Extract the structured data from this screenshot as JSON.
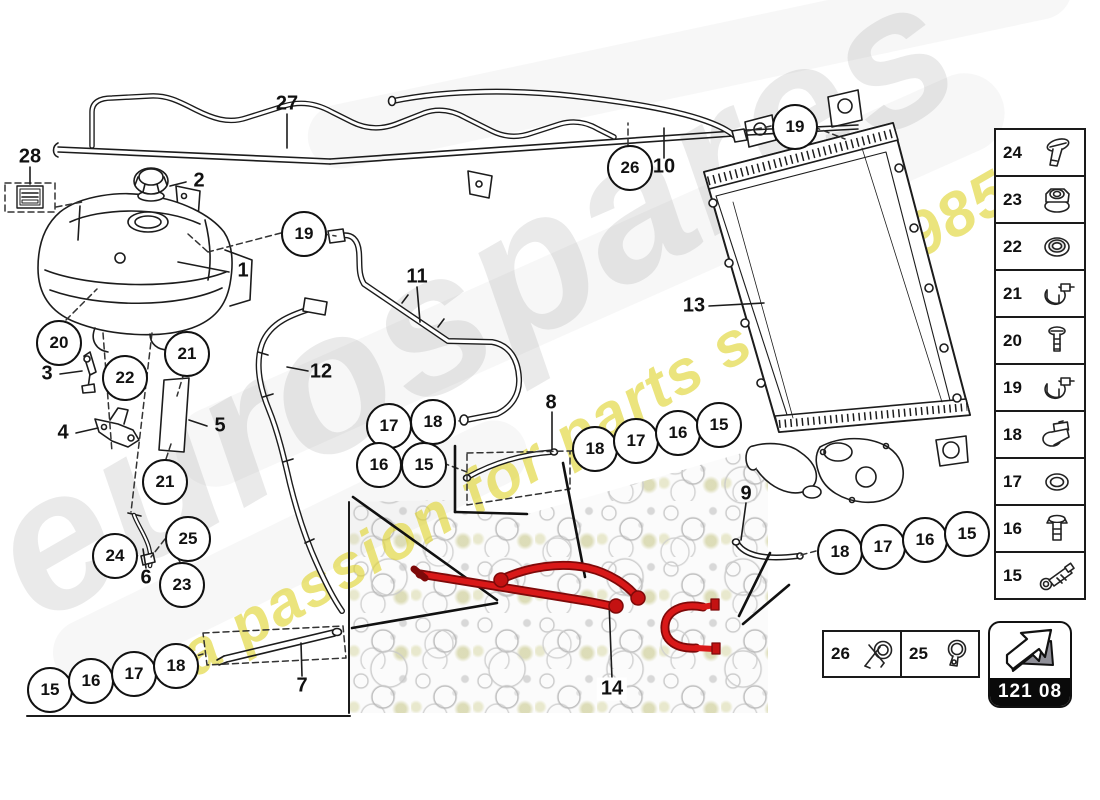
{
  "watermark": {
    "brand": "eurospares",
    "tagline": "a passion for parts since 1985"
  },
  "page_code": "121 08",
  "colors": {
    "highlight_red": "#d91818",
    "watermark_yellow": "#e4dc3c",
    "line": "#1c1c1c"
  },
  "callouts": [
    {
      "n": "19",
      "x": 302,
      "y": 232
    },
    {
      "n": "20",
      "x": 57,
      "y": 341
    },
    {
      "n": "21",
      "x": 185,
      "y": 352
    },
    {
      "n": "22",
      "x": 123,
      "y": 376
    },
    {
      "n": "21",
      "x": 163,
      "y": 480
    },
    {
      "n": "24",
      "x": 113,
      "y": 554
    },
    {
      "n": "25",
      "x": 186,
      "y": 537
    },
    {
      "n": "23",
      "x": 180,
      "y": 583
    },
    {
      "n": "26",
      "x": 628,
      "y": 166
    },
    {
      "n": "19",
      "x": 793,
      "y": 125
    },
    {
      "n": "17",
      "x": 387,
      "y": 424
    },
    {
      "n": "18",
      "x": 431,
      "y": 420
    },
    {
      "n": "16",
      "x": 377,
      "y": 463
    },
    {
      "n": "15",
      "x": 422,
      "y": 463
    },
    {
      "n": "18",
      "x": 593,
      "y": 447
    },
    {
      "n": "17",
      "x": 634,
      "y": 439
    },
    {
      "n": "16",
      "x": 676,
      "y": 431
    },
    {
      "n": "15",
      "x": 717,
      "y": 423
    },
    {
      "n": "18",
      "x": 838,
      "y": 550
    },
    {
      "n": "17",
      "x": 881,
      "y": 545
    },
    {
      "n": "16",
      "x": 923,
      "y": 538
    },
    {
      "n": "15",
      "x": 965,
      "y": 532
    },
    {
      "n": "15",
      "x": 48,
      "y": 688
    },
    {
      "n": "16",
      "x": 89,
      "y": 679
    },
    {
      "n": "17",
      "x": 132,
      "y": 672
    },
    {
      "n": "18",
      "x": 174,
      "y": 664
    }
  ],
  "part_labels": [
    {
      "n": "27",
      "x": 287,
      "y": 104
    },
    {
      "n": "28",
      "x": 30,
      "y": 157
    },
    {
      "n": "2",
      "x": 199,
      "y": 181
    },
    {
      "n": "1",
      "x": 243,
      "y": 271
    },
    {
      "n": "3",
      "x": 47,
      "y": 374
    },
    {
      "n": "4",
      "x": 63,
      "y": 433
    },
    {
      "n": "5",
      "x": 220,
      "y": 426
    },
    {
      "n": "12",
      "x": 321,
      "y": 372
    },
    {
      "n": "11",
      "x": 417,
      "y": 277
    },
    {
      "n": "6",
      "x": 146,
      "y": 578
    },
    {
      "n": "7",
      "x": 302,
      "y": 686
    },
    {
      "n": "8",
      "x": 551,
      "y": 403
    },
    {
      "n": "10",
      "x": 664,
      "y": 167
    },
    {
      "n": "13",
      "x": 694,
      "y": 306
    },
    {
      "n": "9",
      "x": 746,
      "y": 494
    },
    {
      "n": "14",
      "x": 612,
      "y": 689
    }
  ],
  "sidebar": {
    "items": [
      {
        "n": "24",
        "icon": "flat-head-screw"
      },
      {
        "n": "23",
        "icon": "flange-nut"
      },
      {
        "n": "22",
        "icon": "seal-ring"
      },
      {
        "n": "21",
        "icon": "hose-clamp-band"
      },
      {
        "n": "20",
        "icon": "pan-head-screw"
      },
      {
        "n": "19",
        "icon": "hose-clamp-band"
      },
      {
        "n": "18",
        "icon": "spring-clip"
      },
      {
        "n": "17",
        "icon": "washer"
      },
      {
        "n": "16",
        "icon": "hex-bolt"
      },
      {
        "n": "15",
        "icon": "banjo-bolt"
      }
    ]
  },
  "legend": {
    "items": [
      {
        "n": "26",
        "icon": "clamp-with-pliers"
      },
      {
        "n": "25",
        "icon": "hose-clamp-ear"
      }
    ]
  }
}
